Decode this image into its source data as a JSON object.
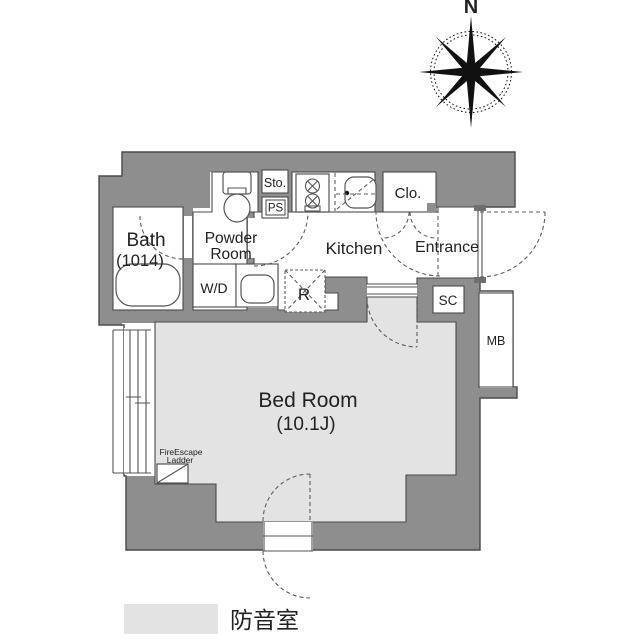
{
  "page": {
    "background": "#ffffff",
    "type": "floor-plan"
  },
  "colors": {
    "wall": "#8e8e8e",
    "outline": "#4a4a4a",
    "soundproof_fill": "#e3e3e3",
    "text": "#222222"
  },
  "compass": {
    "label": "N"
  },
  "rooms": {
    "bath": {
      "name": "Bath",
      "size": "(1014)"
    },
    "powder": {
      "line1": "Powder",
      "line2": "Room"
    },
    "storage": {
      "label": "Sto."
    },
    "pipe_space": {
      "label": "PS"
    },
    "kitchen": {
      "label": "Kitchen"
    },
    "closet": {
      "label": "Clo."
    },
    "entrance": {
      "label": "Entrance"
    },
    "washer_dryer": {
      "label": "W/D"
    },
    "refrigerator": {
      "label": "R"
    },
    "shoe_closet": {
      "label": "SC"
    },
    "meter_box": {
      "label": "MB"
    },
    "bedroom": {
      "name": "Bed Room",
      "size": "(10.1J)"
    },
    "fire_escape": {
      "line1": "FireEscape",
      "line2": "Ladder"
    }
  },
  "legend": {
    "swatch_color": "#e3e3e3",
    "label": "防音室"
  }
}
